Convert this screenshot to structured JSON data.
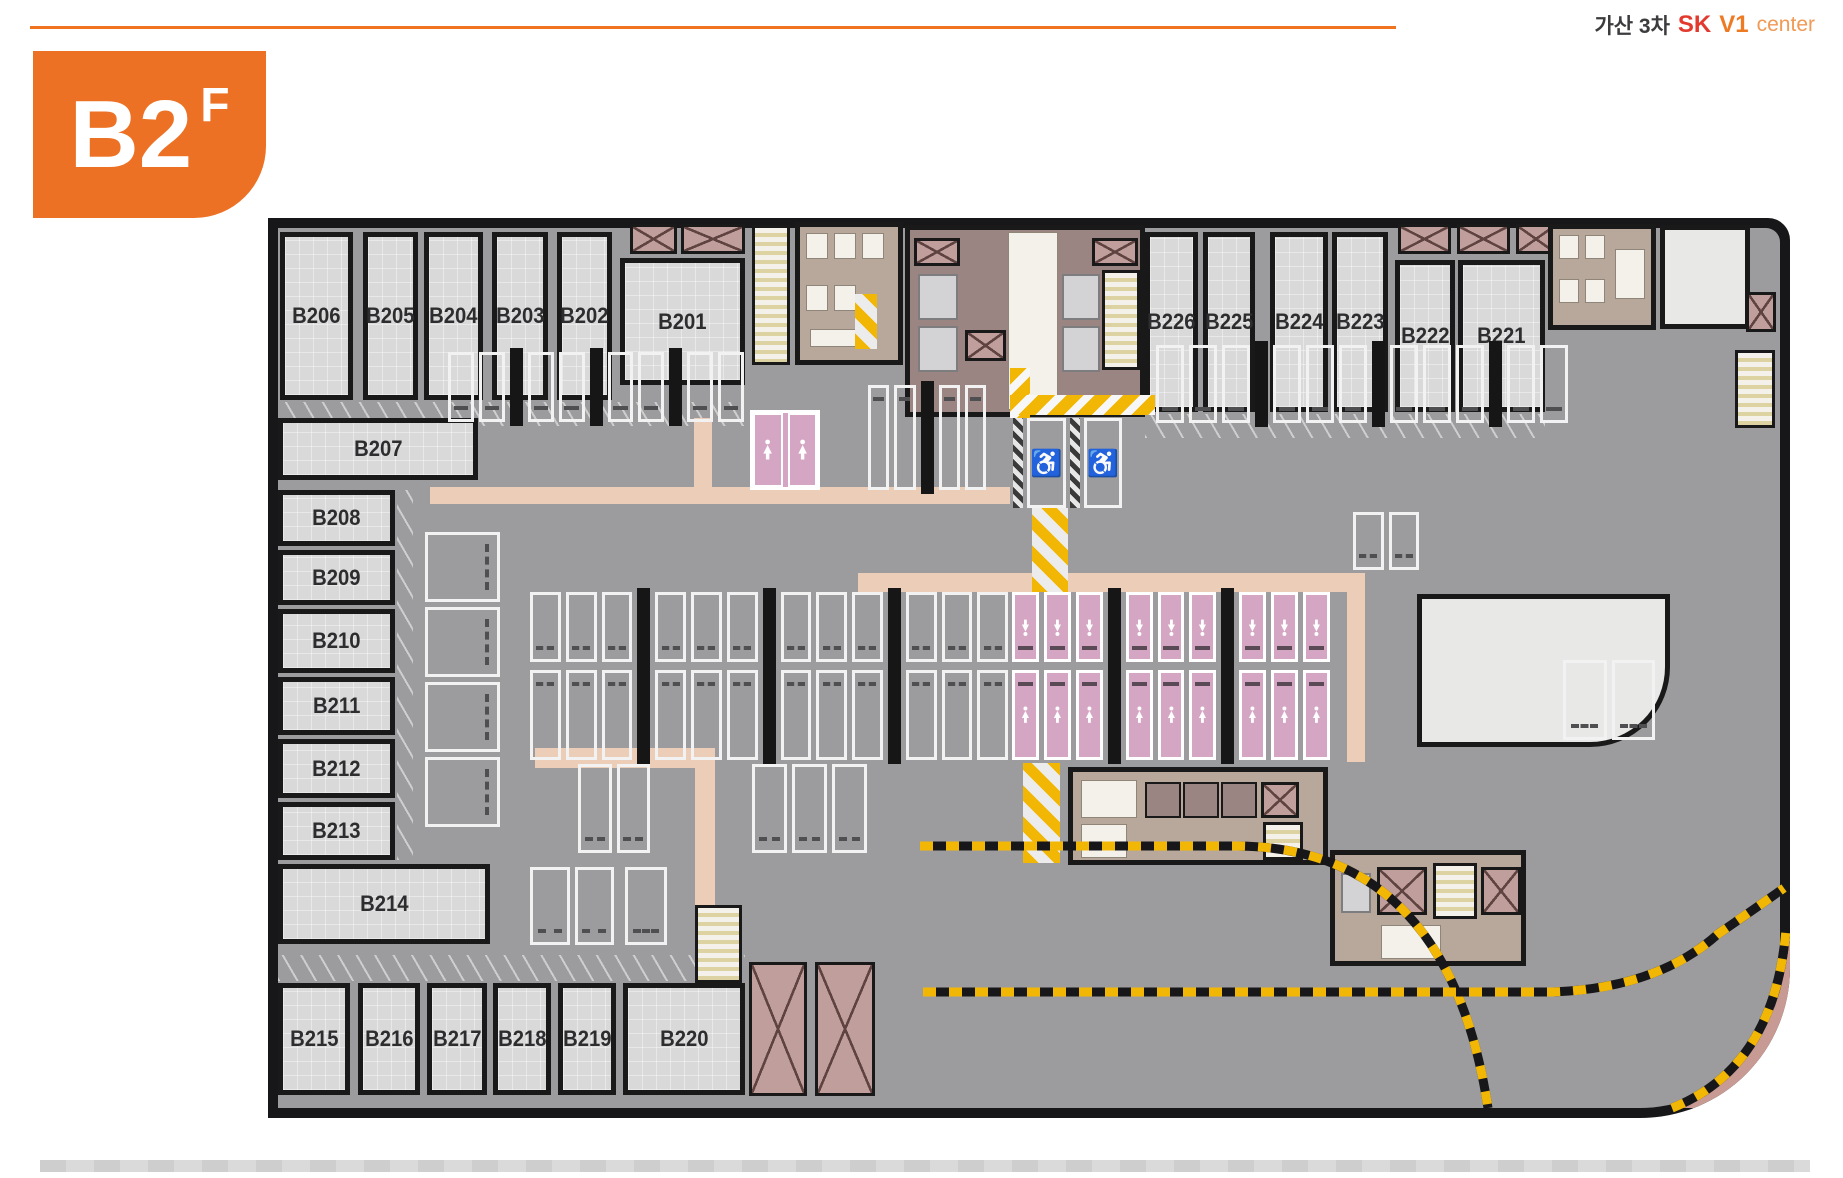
{
  "header": {
    "project": "가산 3차",
    "sk": "SK",
    "v1": "V1",
    "center": "center"
  },
  "floor_badge": {
    "floor": "B2",
    "suffix": "F"
  },
  "rooms": {
    "top_left": [
      "B206",
      "B205",
      "B204",
      "B203",
      "B202",
      "B201"
    ],
    "top_right": [
      "B226",
      "B225",
      "B224",
      "B223",
      "B222",
      "B221"
    ],
    "left": [
      "B207",
      "B208",
      "B209",
      "B210",
      "B211",
      "B212",
      "B213",
      "B214"
    ],
    "bottom": [
      "B215",
      "B216",
      "B217",
      "B218",
      "B219",
      "B220"
    ]
  },
  "icons": {
    "accessible": "♿",
    "women_parking": "woman-figure",
    "restroom": "person-figure"
  },
  "colors": {
    "accent_orange": "#ed7124",
    "sk_red": "#e23a2e",
    "hazard_yellow": "#f2b705",
    "women_parking_pink": "#d5a6c3",
    "core_mauve": "#9b8583",
    "walkway_beige": "#eccdb8",
    "wall_black": "#17171a",
    "aisle_gray": "#9c9c9f"
  }
}
